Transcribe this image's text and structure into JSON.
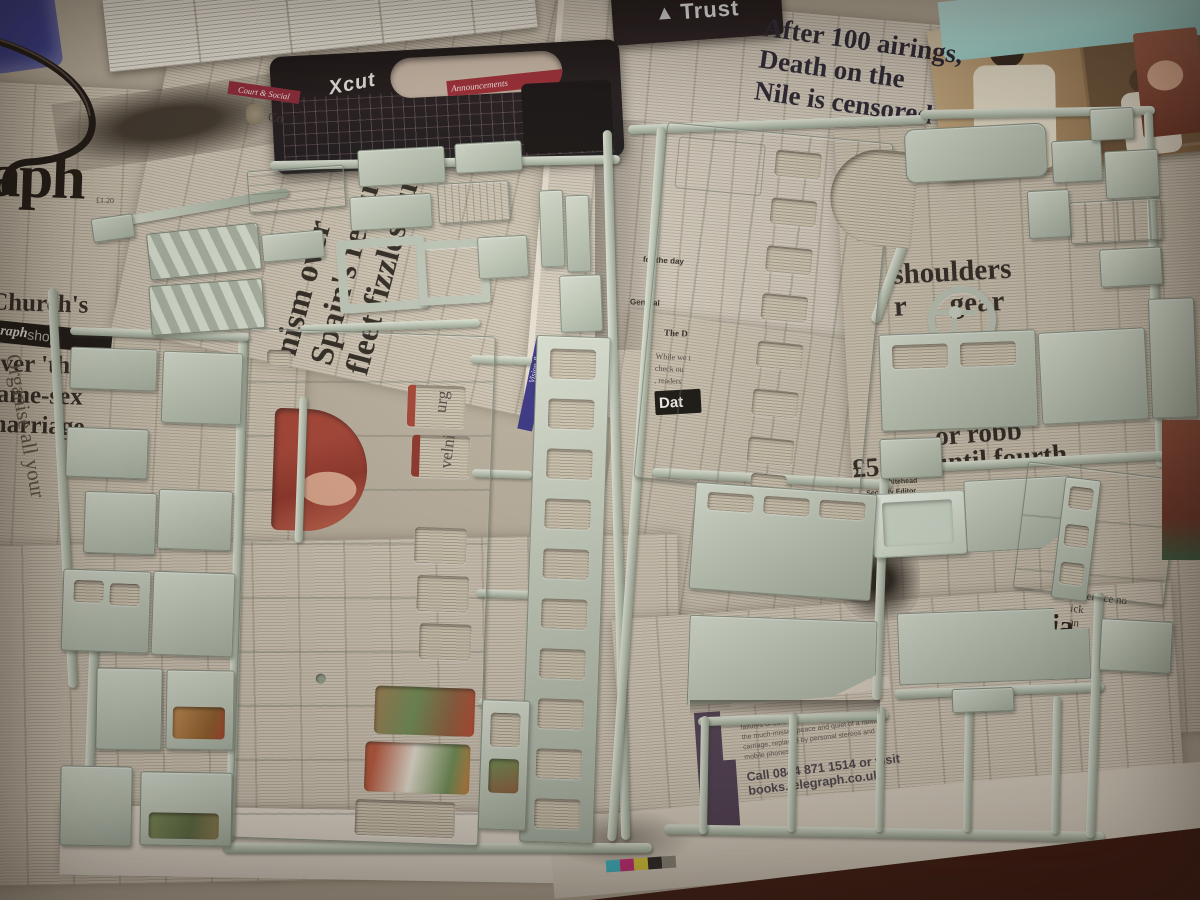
{
  "colors": {
    "paper": "#cbc2b1",
    "plastic": "#b9c3b4",
    "wood_table": "#542415",
    "red_banner": "#8b2133",
    "blue_strip": "#2f2b80",
    "purple_bar": "#4e3d52",
    "cyan_cloth": "#a8dbd6",
    "case_black": "#171113",
    "photo_red": "#a23c2e"
  },
  "newspaper": {
    "masthead_fragment": "aph",
    "price_fragment": "£1.20",
    "shop_strip_serif": "raph",
    "shop_strip_sans": "shop",
    "headlines": {
      "nile": [
        "After 100 airings,",
        "Death on the",
        "Nile is censored"
      ],
      "church": [
        "Church's",
        "warning",
        "over 'threat'",
        "same-sex",
        "marriage"
      ],
      "spain": [
        "nism over",
        "Spain's rescue",
        "fleet fizzles out"
      ],
      "shoulders": [
        "shoulders",
        "r      gear"
      ],
      "robbery": [
        "or robb",
        "£5,000 until fourth"
      ],
      "dementia_fragment": "ntia",
      "selfservice": [
        "lf-service no",
        "ick",
        "an"
      ]
    },
    "sections": {
      "court_social": "Court & Social",
      "court_co_fragment": "Co",
      "vision_radio": "Vision & radio",
      "dat_fragment": "Dat",
      "the_d_fragment": "The D",
      "general_fragment": "General",
      "for_the_day": "for the day",
      "while_lines": [
        "While we t",
        "check ou",
        ", readers"
      ],
      "organise_lines": [
        "Organise all your",
        "in this"
      ]
    },
    "byline": [
      "Tom Whitehead",
      "Security Editor"
    ],
    "letters_fragment": "on trains to the paper over the years",
    "ad": {
      "bullets": [
        "failures of ours",
        "the much-missed peace and quiet of a railway",
        "carriage, replaced by personal stereos and",
        "mobile phones"
      ],
      "call_line": "Call 0844 871 1514 or visit",
      "url": "books.telegraph.co.uk"
    }
  },
  "objects": {
    "trust_logo": "Trust",
    "xcut_logo": "Xcut",
    "announcements_fragment": "Announcements"
  }
}
